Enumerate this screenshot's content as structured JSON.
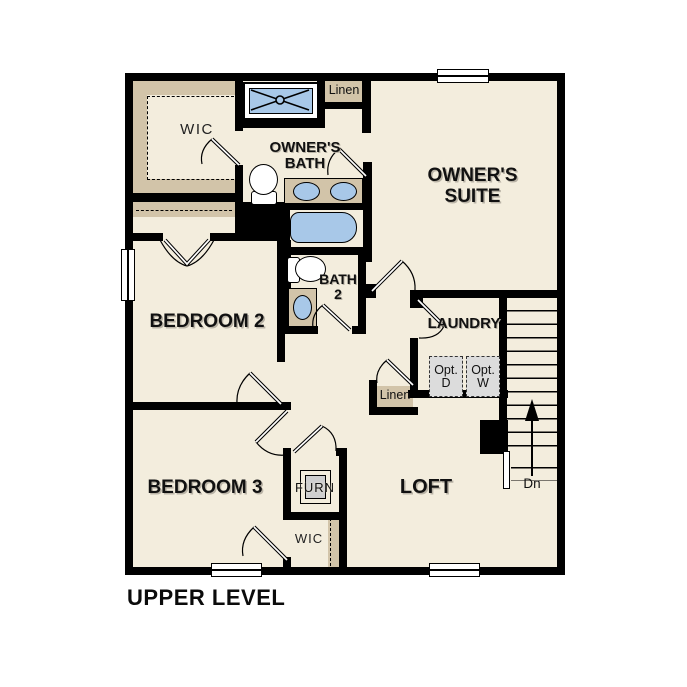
{
  "title": "UPPER LEVEL",
  "colors": {
    "background": "#ffffff",
    "floor": "#f3eddd",
    "wall": "#000000",
    "shelf_tan": "#d2c4a9",
    "fixture_blue": "#a8c8e8",
    "appliance_gray": "#dcdcdc"
  },
  "rooms": {
    "wic_upper": {
      "label": "WIC"
    },
    "owners_bath": {
      "line1": "OWNER'S",
      "line2": "BATH"
    },
    "owners_suite": {
      "line1": "OWNER'S",
      "line2": "SUITE"
    },
    "bedroom2": {
      "label": "BEDROOM 2"
    },
    "bath2": {
      "line1": "BATH",
      "line2": "2"
    },
    "laundry": {
      "label": "LAUNDRY"
    },
    "bedroom3": {
      "label": "BEDROOM 3"
    },
    "loft": {
      "label": "LOFT"
    },
    "wic_lower": {
      "label": "WIC"
    },
    "furnace": {
      "label": "FURN"
    }
  },
  "closets": {
    "linen_upper": {
      "label": "Linen"
    },
    "linen_lower": {
      "label": "Linen"
    }
  },
  "appliances": {
    "opt_dryer": {
      "line1": "Opt.",
      "line2": "D"
    },
    "opt_washer": {
      "line1": "Opt.",
      "line2": "W"
    }
  },
  "stairs": {
    "down_label": "Dn"
  }
}
